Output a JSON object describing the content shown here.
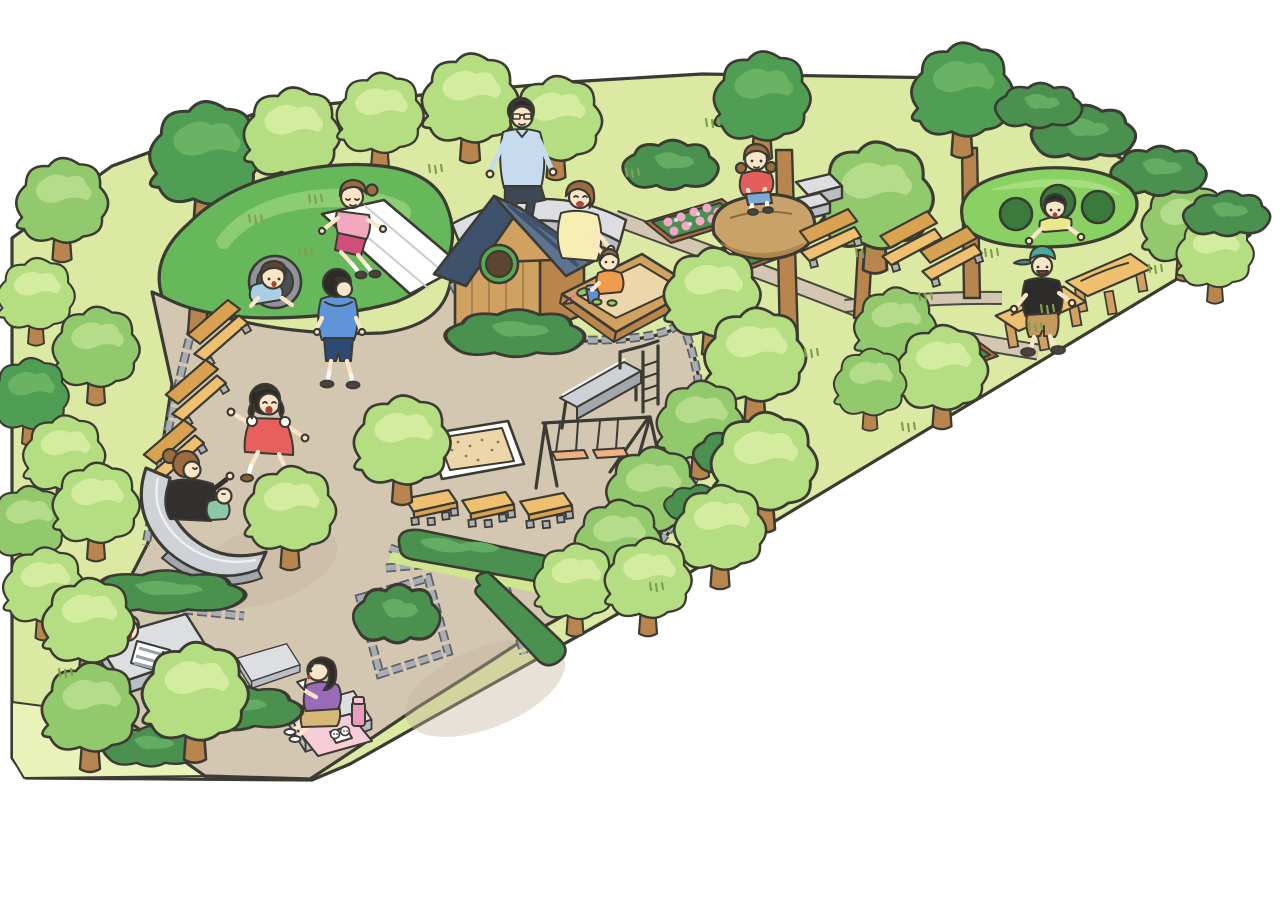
{
  "palette": {
    "outline": "#3b3b33",
    "grass": "#dce9a3",
    "grassLight": "#e9f2b8",
    "path": "#d4c7b2",
    "pathShade": "#c3b39c",
    "cobble": "#a7adb3",
    "cobbleDark": "#5c6167",
    "treeLight": "#b5dd81",
    "treeLightHi": "#d4ec9f",
    "treeMid": "#93c96d",
    "treeMidHi": "#b4dc8b",
    "treeDark": "#4f9e54",
    "treeDarkHi": "#6ab364",
    "trunk": "#b9854f",
    "hill": "#67b75b",
    "hillHi": "#8ccd74",
    "mound": "#8ad164",
    "moundHole": "#3a7a3c",
    "hedge": "#4a9150",
    "hedgeHi": "#63ad62",
    "bench": "#eec06f",
    "benchDark": "#d9a251",
    "benchLeg": "#aeb2b8",
    "stoneTop": "#dcdee1",
    "stoneSide": "#b9bdc4",
    "stoneTrim": "#b08154",
    "sand": "#eed6ab",
    "wood": "#d0a160",
    "woodDark": "#b9854a",
    "roof": "#5d7390",
    "roofDark": "#3f526b",
    "windowRim": "#57a84e",
    "windowIn": "#5c4632",
    "rock": "#c9a26a",
    "rockShade": "#b2854e",
    "metal": "#ced1d5",
    "metalShade": "#a2a6ad",
    "flowerPink": "#f2a9c9",
    "planter": "#b26a40",
    "skin": "#fde5c8",
    "hairBlack": "#2e2a28",
    "hairBrown": "#9c6b3f",
    "hairDarkBrown": "#5a4330",
    "hairLightBrown": "#c29a62",
    "swingSeat": "#f2b184",
    "matPink": "#f6cdd9",
    "slideWhite": "#ffffff"
  },
  "scene": {
    "areas": {
      "lawn": "park lawn",
      "plaza": "sandy playground plaza",
      "lawn_strip": "bottom-left grass strip",
      "trails": "dirt trails on east lawn"
    },
    "equipment": {
      "grass_hill": "play hill with tunnel and roller slide",
      "tunnel": "concrete tunnel through hill",
      "roller_slide": "white roller slide on hill",
      "playhouse": "wooden playhouse with slate roof and round window",
      "sandbox": "wooden sandbox with toys",
      "stone_bench_curved": "curved stone sitting wall",
      "sitting_rock": "large sitting boulder",
      "pod_mound": "green pod mound with three crawl holes",
      "metal_slide": "steel slide with ladder",
      "swing_set": "swing set with two seats",
      "wide_slide": "wide curved slide",
      "sand_pit": "bordered sand pit",
      "benches_with_back": 6,
      "benches_backless": 3,
      "wood_tables": 2,
      "stone_platforms": 3,
      "flower_bed_pink": 1,
      "flower_beds_white": 2,
      "hedges": "clipped hedge planters",
      "sand_toys": [
        "blue bucket",
        "pink shovel",
        "green leaf toy"
      ],
      "picnic_items": [
        "pink picnic mat",
        "rice balls",
        "pink thermos"
      ]
    },
    "people": {
      "girl_roller_slide": {
        "label": "girl sliding down hill roller slide",
        "hair": "#9c6b3f",
        "shirt": "#f3a8c0",
        "bottom": "#d14e79"
      },
      "boy_tunnel": {
        "label": "boy crawling through hill tunnel",
        "hair": "#5a4330",
        "shirt": "#a9cfe6"
      },
      "boy_walking": {
        "label": "boy in hoodie walking on plaza",
        "hair": "#2e2a28",
        "shirt": "#6094d8",
        "bottom": "#2c4a74"
      },
      "man_bench": {
        "label": "man with glasses on stone wall",
        "hair": "#2e2a28",
        "shirt": "#c6dcee",
        "bottom": "#3f4754"
      },
      "mother_sandbox": {
        "label": "mother kneeling at sandbox",
        "hair": "#8a5c36",
        "shirt": "#f6eeb2"
      },
      "toddler_sandbox": {
        "label": "toddler playing in sandbox",
        "hair": "#9c6b3f",
        "shirt": "#f09a4e",
        "shoes": "#9ccf60"
      },
      "girl_rock": {
        "label": "girl crouching on boulder",
        "hair": "#9c6b3f",
        "shirt": "#e45f5c",
        "bottom": "#7fa8d8"
      },
      "boy_pod_mound": {
        "label": "boy peeking out of pod mound hole",
        "hair": "#2e2a28",
        "shirt": "#ece789"
      },
      "boy_tables": {
        "label": "boy with cap between wooden tables",
        "hat": "#4aa89a",
        "shirt": "#2e2c2a",
        "bottom": "#c49a5c"
      },
      "girl_running": {
        "label": "girl running in red dress",
        "hair": "#2e2a28",
        "shirt": "#e8605e"
      },
      "mother_baby_slide": {
        "label": "mother with baby atop wide slide",
        "hair": "#8a5c36",
        "shirt": "#332f2e",
        "baby": "#8cc8a8"
      },
      "boy_lying": {
        "label": "boy lying on stone platform",
        "hair": "#c29a62",
        "shirt": "#ffffff",
        "bottom": "#8ec4e0"
      },
      "girl_picnic": {
        "label": "girl eating rice ball on platform",
        "hair": "#2e2a28",
        "shirt": "#9a6bb8",
        "bottom": "#d8b878"
      }
    }
  }
}
